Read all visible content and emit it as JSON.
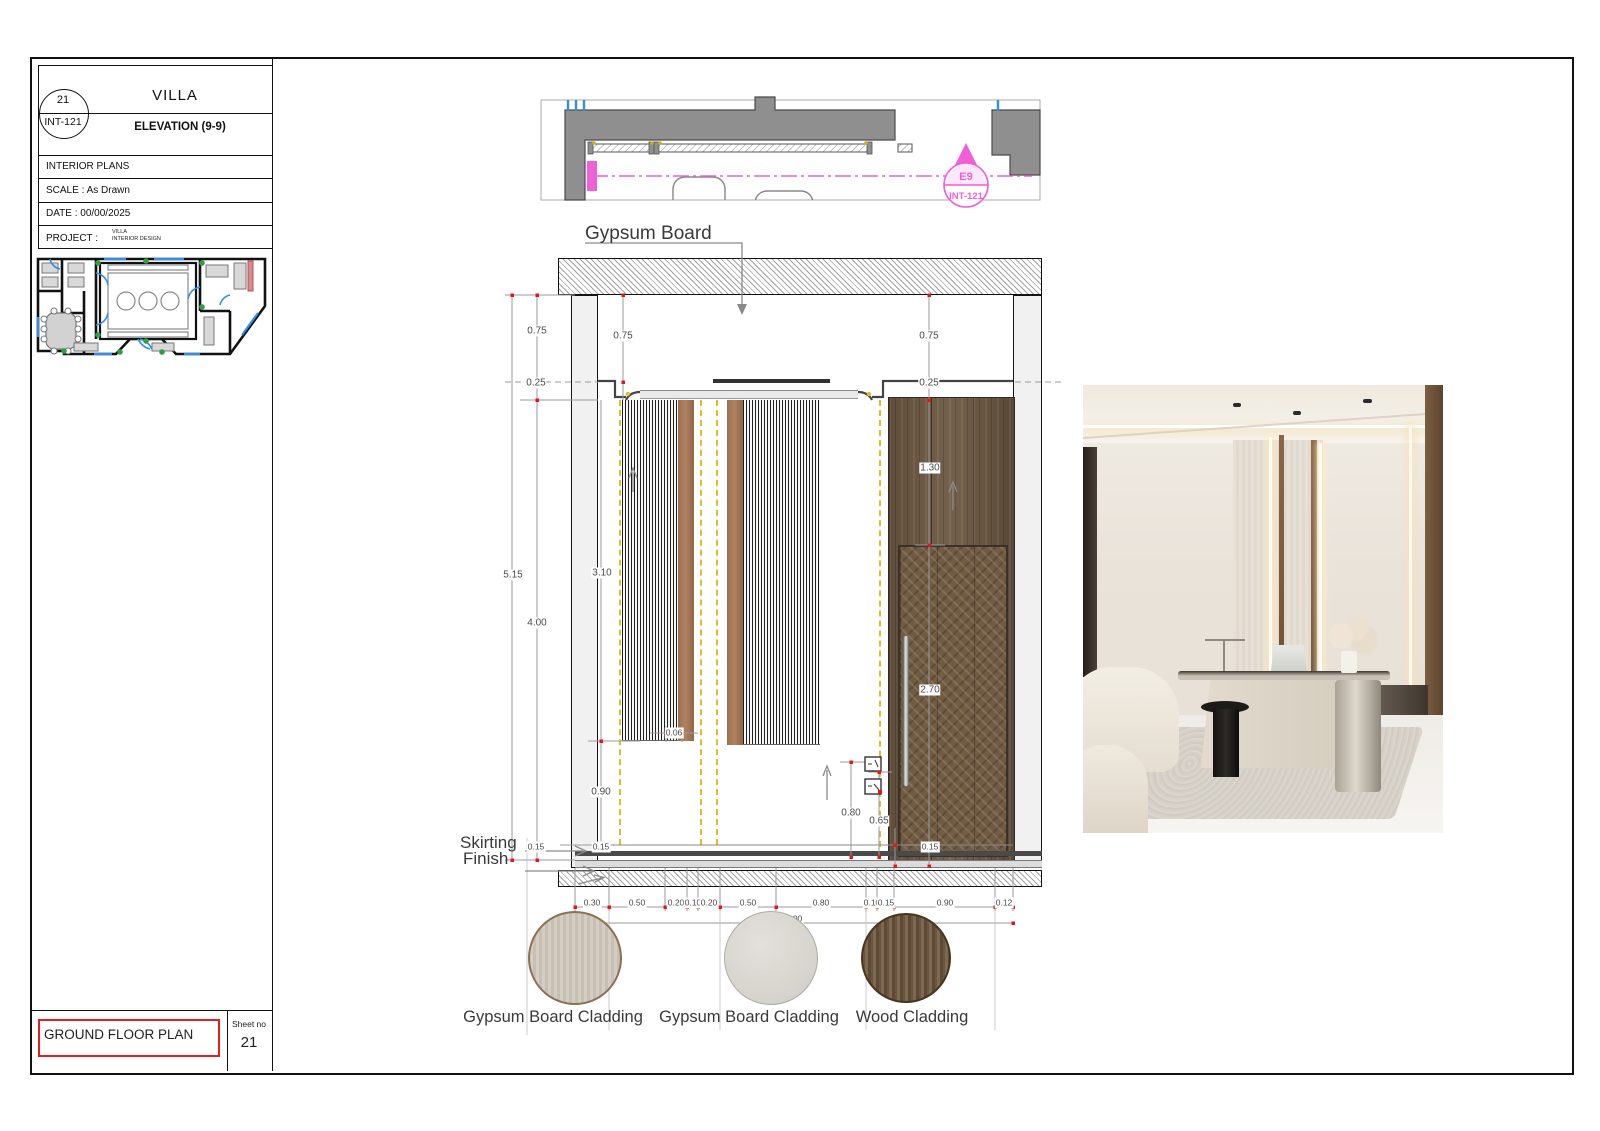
{
  "titleblock": {
    "number": "21",
    "code": "INT-121",
    "project": "VILLA",
    "title": "ELEVATION (9-9)",
    "category": "INTERIOR PLANS",
    "scale": "SCALE : As Drawn",
    "date": "DATE : 00/00/2025",
    "project_label": "PROJECT :",
    "project_line1": "VILLA",
    "project_line2": "INTERIOR DESIGN",
    "footer_title": "GROUND FLOOR PLAN",
    "sheet_no_label": "Sheet no",
    "sheet_no": "21"
  },
  "plan_strip": {
    "marker_top": "E9",
    "marker_bottom": "INT-121"
  },
  "elevation": {
    "ceiling_label": "Gypsum Board",
    "skirting_label": "Skirting",
    "finish_label": "Finish",
    "total_width_label": "3.90",
    "dim_labels": [
      {
        "t": "0.75",
        "x": 537,
        "y": 331
      },
      {
        "t": "0.75",
        "x": 623,
        "y": 336
      },
      {
        "t": "0.75",
        "x": 929,
        "y": 336
      },
      {
        "t": "0.25",
        "x": 536,
        "y": 383
      },
      {
        "t": "0.25",
        "x": 929,
        "y": 383
      },
      {
        "t": "5.15",
        "x": 513,
        "y": 575
      },
      {
        "t": "4.00",
        "x": 537,
        "y": 623
      },
      {
        "t": "3.10",
        "x": 602,
        "y": 573
      },
      {
        "t": "1.30",
        "x": 930,
        "y": 468
      },
      {
        "t": "0.90",
        "x": 601,
        "y": 792
      },
      {
        "t": "2.70",
        "x": 930,
        "y": 690
      },
      {
        "t": "0.80",
        "x": 851,
        "y": 813
      },
      {
        "t": "0.65",
        "x": 879,
        "y": 821
      },
      {
        "t": "0.15",
        "x": 536,
        "y": 847,
        "s": 1
      },
      {
        "t": "0.15",
        "x": 601,
        "y": 847,
        "s": 1
      },
      {
        "t": "0.15",
        "x": 930,
        "y": 847,
        "s": 1
      },
      {
        "t": "0.06",
        "x": 674,
        "y": 733,
        "s": 1
      },
      {
        "t": "0.30",
        "x": 592,
        "y": 903,
        "s": 1
      },
      {
        "t": "0.50",
        "x": 637,
        "y": 903,
        "s": 1
      },
      {
        "t": "0.20",
        "x": 676,
        "y": 903,
        "s": 1
      },
      {
        "t": "0.10",
        "x": 693,
        "y": 903,
        "s": 1
      },
      {
        "t": "0.20",
        "x": 709,
        "y": 903,
        "s": 1
      },
      {
        "t": "0.50",
        "x": 748,
        "y": 903,
        "s": 1
      },
      {
        "t": "0.80",
        "x": 821,
        "y": 903,
        "s": 1
      },
      {
        "t": "0.10",
        "x": 872,
        "y": 903,
        "s": 1
      },
      {
        "t": "0.15",
        "x": 886,
        "y": 903,
        "s": 1
      },
      {
        "t": "0.90",
        "x": 945,
        "y": 903,
        "s": 1
      },
      {
        "t": "0.12",
        "x": 1004,
        "y": 903,
        "s": 1
      },
      {
        "t": "3.90",
        "x": 794,
        "y": 919,
        "s": 1
      }
    ]
  },
  "materials": [
    {
      "name": "Gypsum Board Cladding"
    },
    {
      "name": "Gypsum Board Cladding"
    },
    {
      "name": "Wood Cladding"
    }
  ],
  "colors": {
    "accent_magenta": "#ee5fd9",
    "dim_red": "#e81414",
    "led_yellow": "#e0bd2a",
    "wood_dark": "#6d5943",
    "wood_strip": "#a5795a"
  }
}
